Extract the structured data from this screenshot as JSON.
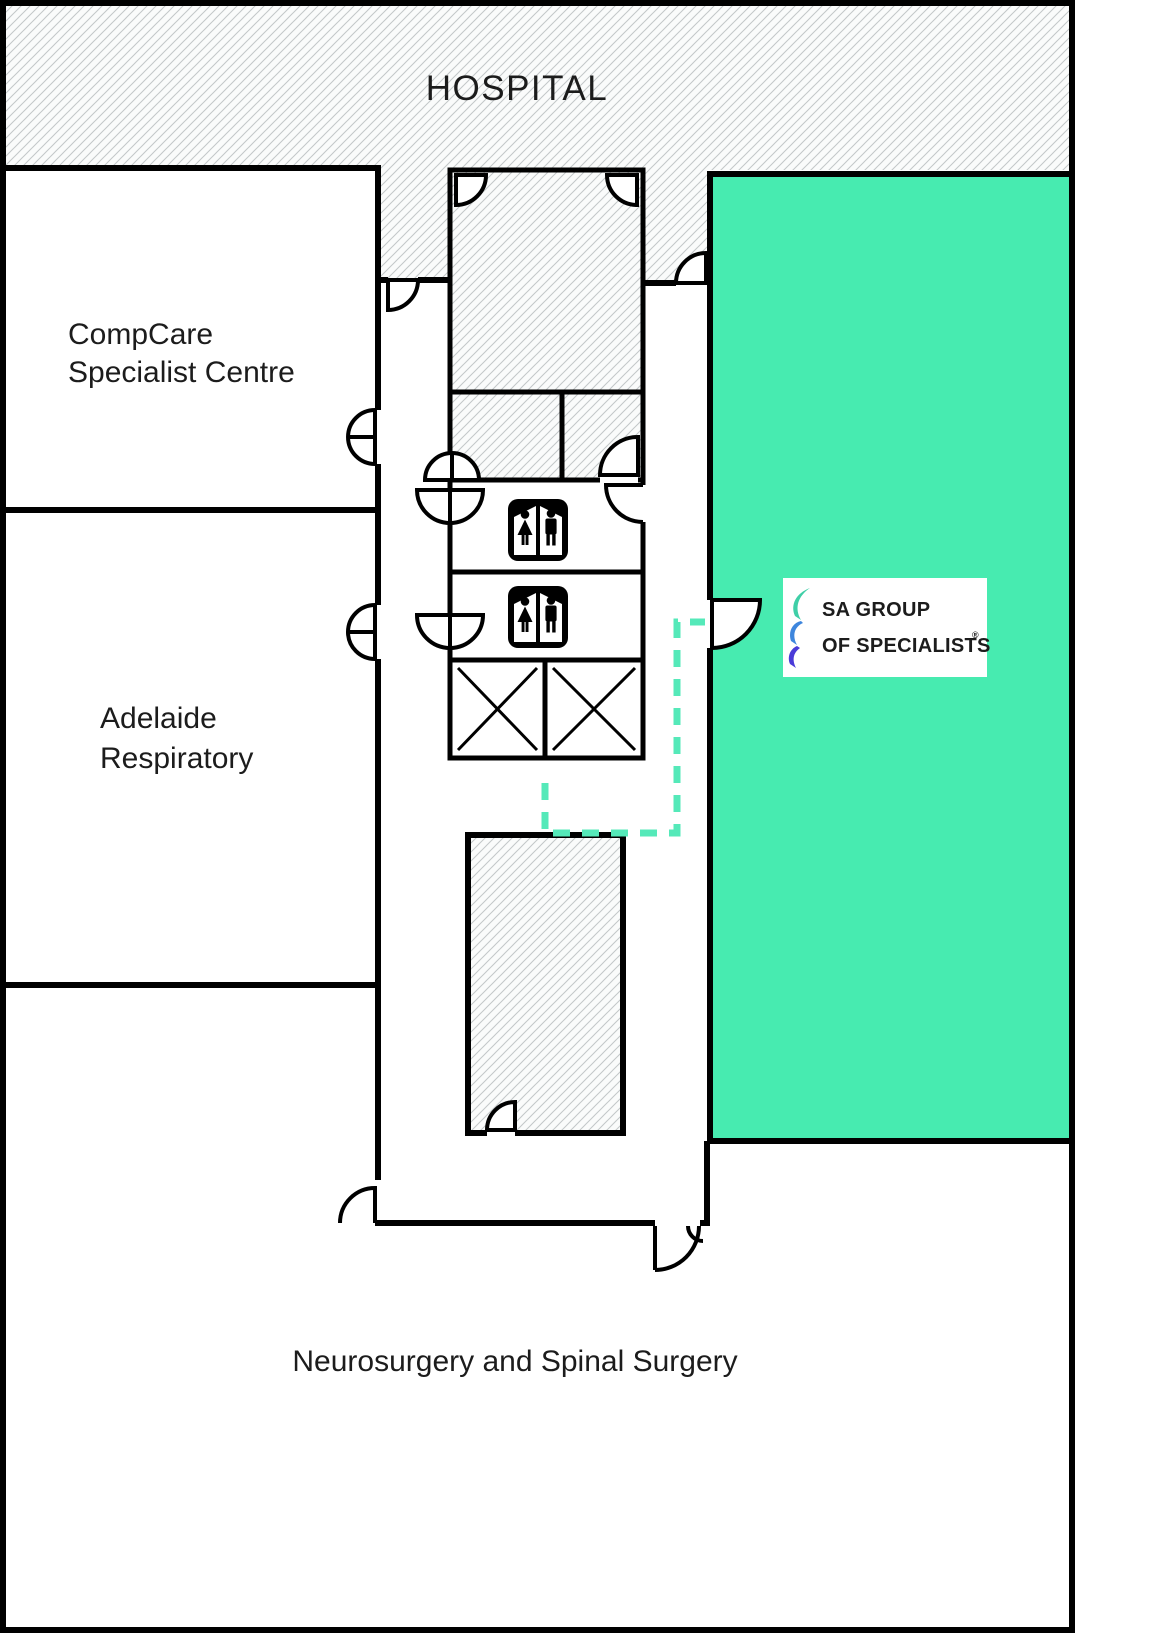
{
  "map_title": "Hospital specialist centre floor plan",
  "labels": {
    "hospital": "HOSPITAL",
    "compcare_line1": "CompCare",
    "compcare_line2": "Specialist Centre",
    "adelaide_line1": "Adelaide",
    "adelaide_line2": "Respiratory",
    "neurosurgery": "Neurosurgery and Spinal Surgery"
  },
  "logo": {
    "line1": "SA GROUP",
    "line2": "OF SPECIALISTS",
    "mark": "®"
  },
  "colors": {
    "suite_fill": "#47EBB0",
    "route": "#55E9B9",
    "wall": "#000000",
    "hatch_line": "#c3c7c9",
    "hatch_bg": "#fafbfb",
    "logo_text": "#363E44",
    "ribbon_teal": "#3FCFA7",
    "ribbon_blue": "#3E86DD",
    "ribbon_indigo": "#4A3BD8"
  },
  "icons": {
    "restroom": "unisex-restroom-icon",
    "elevator": "elevator-x-icon",
    "door": "door-swing-arc",
    "route": "dashed-route-line"
  }
}
